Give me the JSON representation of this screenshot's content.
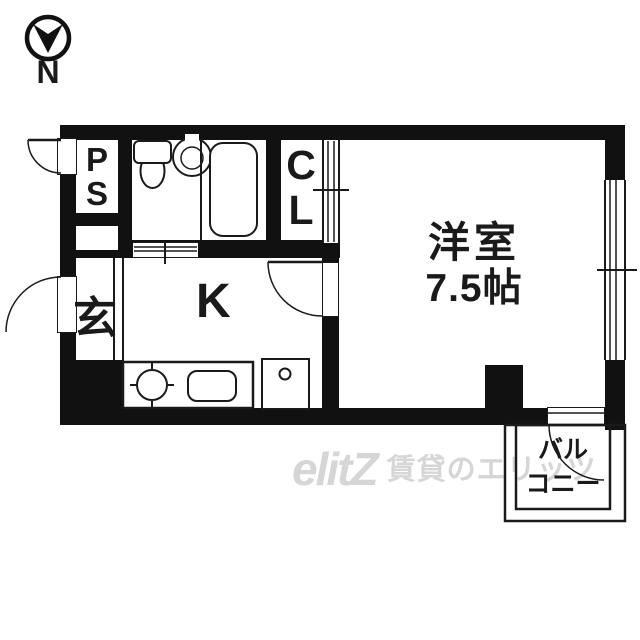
{
  "compass": {
    "label": "N"
  },
  "rooms": {
    "ps": [
      "P",
      "S"
    ],
    "entrance": "玄",
    "kitchen": "K",
    "closet": [
      "C",
      "L"
    ],
    "main_room": {
      "name": "洋室",
      "size": "7.5帖"
    },
    "balcony": [
      "バル",
      "コニー"
    ]
  },
  "watermark": {
    "logo": "elitZ",
    "text": "賃貸のエリッツ"
  },
  "colors": {
    "line": "#1a1a1a",
    "wall": "#111111",
    "watermark": "#d6d6d6",
    "background": "#ffffff"
  }
}
